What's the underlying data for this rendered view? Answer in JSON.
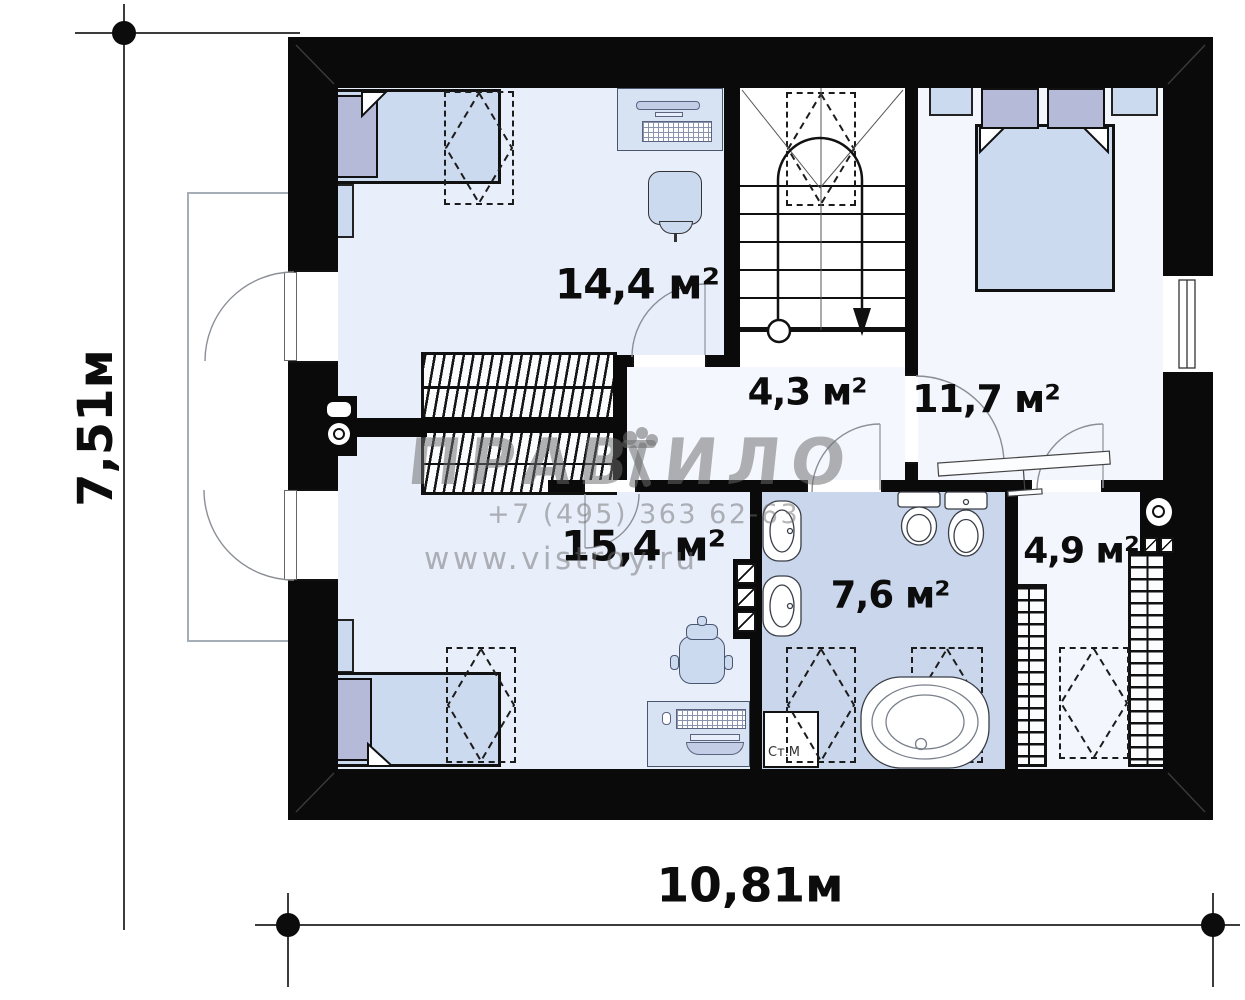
{
  "plan": {
    "rooms": [
      {
        "id": "bedroom-top-left",
        "area_label": "14,4 м²"
      },
      {
        "id": "stair-hall",
        "area_label": "4,3 м²"
      },
      {
        "id": "bedroom-right",
        "area_label": "11,7 м²"
      },
      {
        "id": "bedroom-bottom-left",
        "area_label": "15,4 м²"
      },
      {
        "id": "bathroom",
        "area_label": "7,6 м²"
      },
      {
        "id": "wardrobe-room",
        "area_label": "4,9 м²"
      }
    ],
    "appliances": {
      "washing_machine_label": "Ст.М"
    }
  },
  "dimensions": {
    "width_label": "10,81м",
    "height_label": "7,51м"
  },
  "watermark": {
    "brand_left": "ПРАВ",
    "brand_right": "ИЛО",
    "phone": "+7 (495) 363 62-63",
    "website": "www.vistroy.ru"
  },
  "colors": {
    "wall": "#0a0a0a",
    "room_floor": "#e9eefb",
    "hall_floor": "#f4f7fd",
    "bathroom_floor": "#c9d6ec",
    "furniture": "#ccdaf0",
    "pillow": "#b5bad8"
  }
}
